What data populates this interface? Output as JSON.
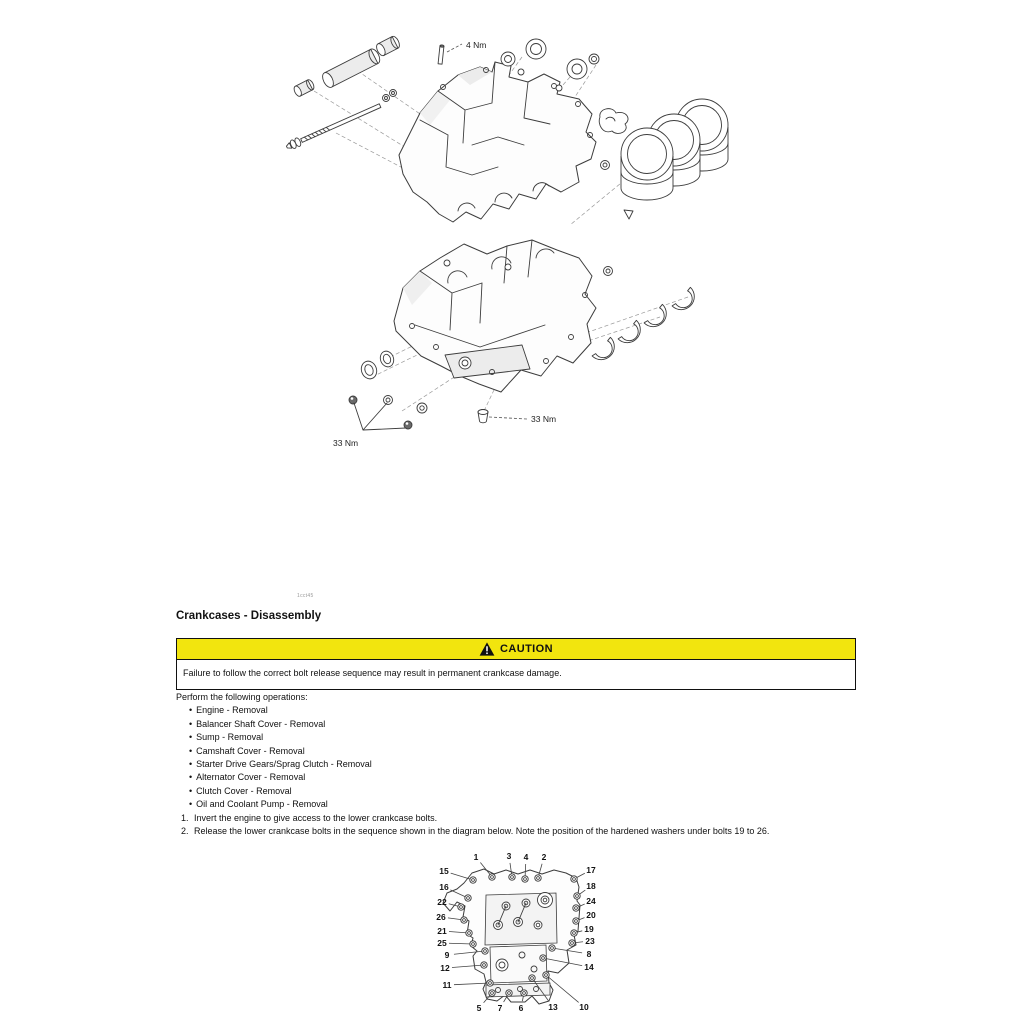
{
  "colors": {
    "caution_yellow": "#f2e50e",
    "text": "#111111"
  },
  "figure_code": "1cct45",
  "section": {
    "title": "Crankcases - Disassembly"
  },
  "exploded": {
    "torque_pin": "4 Nm",
    "torque_bolts_left": "33 Nm",
    "torque_bolt_right": "33 Nm"
  },
  "caution": {
    "label": "CAUTION",
    "icon": "warning-triangle-icon",
    "text": "Failure to follow the correct bolt release sequence may result in permanent crankcase damage."
  },
  "procedure": {
    "intro": "Perform the following operations:",
    "operations": [
      "Engine - Removal",
      "Balancer Shaft Cover - Removal",
      "Sump - Removal",
      "Camshaft Cover - Removal",
      "Starter Drive Gears/Sprag Clutch - Removal",
      "Alternator Cover - Removal",
      "Clutch Cover - Removal",
      "Oil and Coolant Pump - Removal"
    ],
    "steps": [
      {
        "num": "1.",
        "text": "Invert the engine to give access to the lower crankcase bolts."
      },
      {
        "num": "2.",
        "text": "Release the lower crankcase bolts in the sequence shown in the diagram below. Note the position of the hardened washers under bolts 19 to 26."
      }
    ]
  },
  "sequence_diagram": {
    "callouts": [
      {
        "n": "1",
        "x": 48,
        "y": 14,
        "lx": 64,
        "ly": 34
      },
      {
        "n": "3",
        "x": 81,
        "y": 13,
        "lx": 84,
        "ly": 34
      },
      {
        "n": "4",
        "x": 98,
        "y": 14,
        "lx": 97,
        "ly": 36
      },
      {
        "n": "2",
        "x": 116,
        "y": 14,
        "lx": 110,
        "ly": 35
      },
      {
        "n": "15",
        "x": 16,
        "y": 28,
        "lx": 45,
        "ly": 37
      },
      {
        "n": "17",
        "x": 163,
        "y": 27,
        "lx": 146,
        "ly": 36
      },
      {
        "n": "16",
        "x": 16,
        "y": 44,
        "lx": 40,
        "ly": 55
      },
      {
        "n": "18",
        "x": 163,
        "y": 43,
        "lx": 149,
        "ly": 53
      },
      {
        "n": "22",
        "x": 14,
        "y": 59,
        "lx": 33,
        "ly": 64
      },
      {
        "n": "24",
        "x": 163,
        "y": 58,
        "lx": 148,
        "ly": 65
      },
      {
        "n": "26",
        "x": 13,
        "y": 74,
        "lx": 36,
        "ly": 77
      },
      {
        "n": "20",
        "x": 163,
        "y": 72,
        "lx": 148,
        "ly": 78
      },
      {
        "n": "21",
        "x": 14,
        "y": 88,
        "lx": 41,
        "ly": 90
      },
      {
        "n": "19",
        "x": 161,
        "y": 86,
        "lx": 146,
        "ly": 90
      },
      {
        "n": "25",
        "x": 14,
        "y": 100,
        "lx": 45,
        "ly": 101
      },
      {
        "n": "23",
        "x": 162,
        "y": 98,
        "lx": 144,
        "ly": 100
      },
      {
        "n": "9",
        "x": 19,
        "y": 112,
        "lx": 57,
        "ly": 108
      },
      {
        "n": "8",
        "x": 161,
        "y": 111,
        "lx": 124,
        "ly": 105
      },
      {
        "n": "12",
        "x": 17,
        "y": 125,
        "lx": 56,
        "ly": 122
      },
      {
        "n": "14",
        "x": 161,
        "y": 124,
        "lx": 115,
        "ly": 115
      },
      {
        "n": "11",
        "x": 19,
        "y": 142,
        "lx": 62,
        "ly": 140
      },
      {
        "n": "10",
        "x": 156,
        "y": 164,
        "lx": 118,
        "ly": 132
      },
      {
        "n": "5",
        "x": 51,
        "y": 165,
        "lx": 64,
        "ly": 150
      },
      {
        "n": "7",
        "x": 72,
        "y": 165,
        "lx": 81,
        "ly": 150
      },
      {
        "n": "6",
        "x": 93,
        "y": 165,
        "lx": 96,
        "ly": 150
      },
      {
        "n": "13",
        "x": 125,
        "y": 164,
        "lx": 104,
        "ly": 135
      }
    ]
  }
}
